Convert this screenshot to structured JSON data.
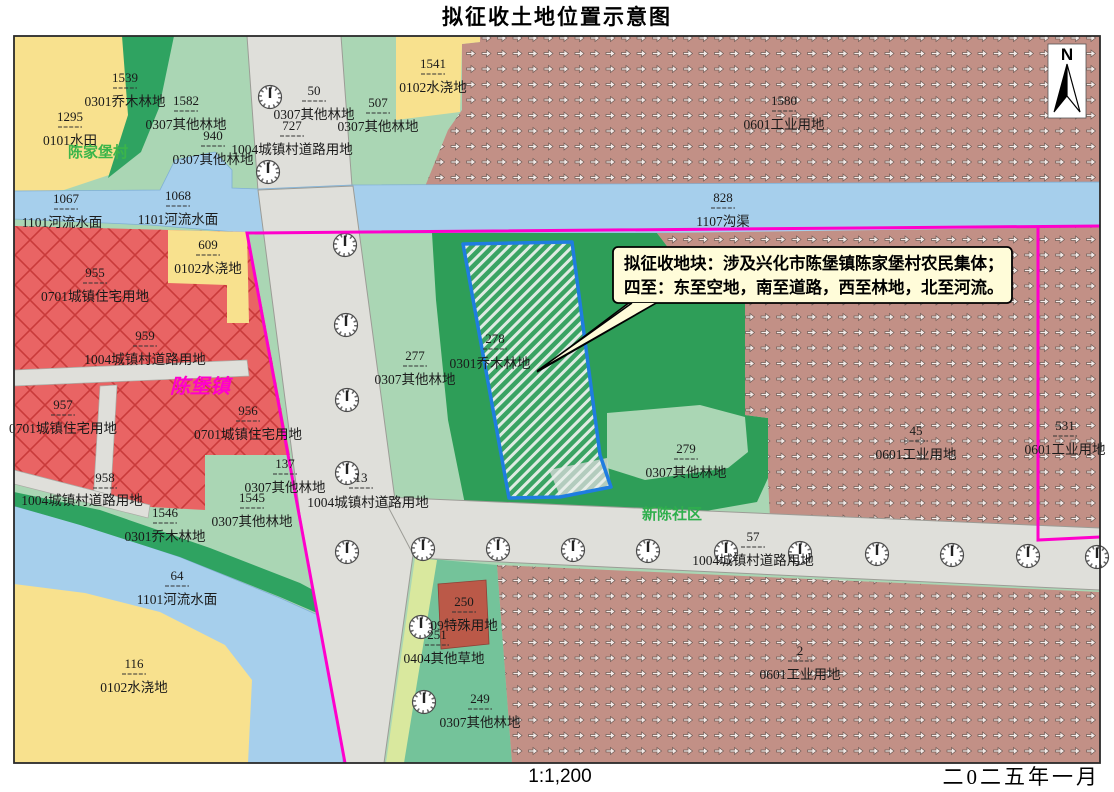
{
  "title": "拟征收土地位置示意图",
  "scale_label": "1:1,200",
  "date_label": "二0二五年一月",
  "north_label": "N",
  "callout": {
    "line1": "拟征收地块：涉及兴化市陈堡镇陈家堡村农民集体；",
    "line2": "四至：东至空地，南至道路，西至林地，北至河流。"
  },
  "target_parcel": {
    "number": "278",
    "type": "0301乔木林地"
  },
  "place_names": [
    {
      "text": "陈家堡村",
      "x": 98,
      "y": 157,
      "color": "#3BB54A",
      "size": 15,
      "italic": false
    },
    {
      "text": "陈堡镇",
      "x": 200,
      "y": 393,
      "color": "#FF00CC",
      "size": 20,
      "italic": true
    },
    {
      "text": "新陈社区",
      "x": 672,
      "y": 519,
      "color": "#2FAF4D",
      "size": 15,
      "italic": false
    }
  ],
  "parcels": [
    {
      "num": "1539",
      "type": "0301乔木林地",
      "x": 125,
      "y": 78
    },
    {
      "num": "1295",
      "type": "0101水田",
      "x": 70,
      "y": 117
    },
    {
      "num": "1582",
      "type": "0307其他林地",
      "x": 186,
      "y": 101
    },
    {
      "num": "940",
      "type": "0307其他林地",
      "x": 213,
      "y": 136
    },
    {
      "num": "50",
      "type": "0307其他林地",
      "x": 314,
      "y": 91
    },
    {
      "num": "727",
      "type": "1004城镇村道路用地",
      "x": 292,
      "y": 126
    },
    {
      "num": "507",
      "type": "0307其他林地",
      "x": 378,
      "y": 103
    },
    {
      "num": "1541",
      "type": "0102水浇地",
      "x": 433,
      "y": 64
    },
    {
      "num": "1580",
      "type": "0601工业用地",
      "x": 784,
      "y": 101
    },
    {
      "num": "1067",
      "type": "1101河流水面",
      "x": 66,
      "y": 199,
      "tx": 62,
      "ty": 223
    },
    {
      "num": "1068",
      "type": "1101河流水面",
      "x": 178,
      "y": 196
    },
    {
      "num": "828",
      "type": "1107沟渠",
      "x": 723,
      "y": 198
    },
    {
      "num": "609",
      "type": "0102水浇地",
      "x": 208,
      "y": 245
    },
    {
      "num": "955",
      "type": "0701城镇住宅用地",
      "x": 95,
      "y": 273
    },
    {
      "num": "959",
      "type": "1004城镇村道路用地",
      "x": 145,
      "y": 336
    },
    {
      "num": "957",
      "type": "0701城镇住宅用地",
      "x": 63,
      "y": 405
    },
    {
      "num": "956",
      "type": "0701城镇住宅用地",
      "x": 248,
      "y": 411
    },
    {
      "num": "958",
      "type": "1004城镇村道路用地",
      "x": 105,
      "y": 478,
      "tx": 82,
      "ty": 501
    },
    {
      "num": "1546",
      "type": "0301乔木林地",
      "x": 165,
      "y": 513
    },
    {
      "num": "137",
      "type": "0307其他林地",
      "x": 285,
      "y": 464
    },
    {
      "num": "1545",
      "type": "0307其他林地",
      "x": 252,
      "y": 498
    },
    {
      "num": "277",
      "type": "0307其他林地",
      "x": 415,
      "y": 356
    },
    {
      "num": "278",
      "type": "0301乔木林地",
      "x": 495,
      "y": 339,
      "tx": 490,
      "ty": 364
    },
    {
      "num": "13",
      "type": "1004城镇村道路用地",
      "x": 361,
      "y": 478,
      "tx": 368,
      "ty": 503
    },
    {
      "num": "279",
      "type": "0307其他林地",
      "x": 686,
      "y": 449
    },
    {
      "num": "57",
      "type": "1004城镇村道路用地",
      "x": 753,
      "y": 537
    },
    {
      "num": "45",
      "type": "0601工业用地",
      "x": 916,
      "y": 431
    },
    {
      "num": "531",
      "type": "0601工业用地",
      "x": 1065,
      "y": 426
    },
    {
      "num": "2",
      "type": "0601工业用地",
      "x": 800,
      "y": 651
    },
    {
      "num": "250",
      "type": "09特殊用地",
      "x": 464,
      "y": 602
    },
    {
      "num": "251",
      "type": "0404其他草地",
      "x": 437,
      "y": 635,
      "tx": 444,
      "ty": 659
    },
    {
      "num": "249",
      "type": "0307其他林地",
      "x": 480,
      "y": 699
    },
    {
      "num": "64",
      "type": "1101河流水面",
      "x": 177,
      "y": 576
    },
    {
      "num": "116",
      "type": "0102水浇地",
      "x": 134,
      "y": 664
    }
  ],
  "colors": {
    "boundary_magenta": "#FF00CC",
    "target_outline_blue": "#1F7DE0",
    "water_blue": "#A6CFEC",
    "road_gray": "#DFDFDA",
    "residential_red": "#E96464",
    "residential_hatch_red": "#C93A3A",
    "industrial_brown": "#C29086",
    "forest_dark_green": "#2FA361",
    "forest_pale_green": "#AAD6B4",
    "forest_medium_green": "#74C39A",
    "farm_yellow": "#F8E18E",
    "special_land_red": "#BB5948",
    "grass_strip_green": "#D9E89E",
    "callout_bg": "#FFFCD9"
  }
}
